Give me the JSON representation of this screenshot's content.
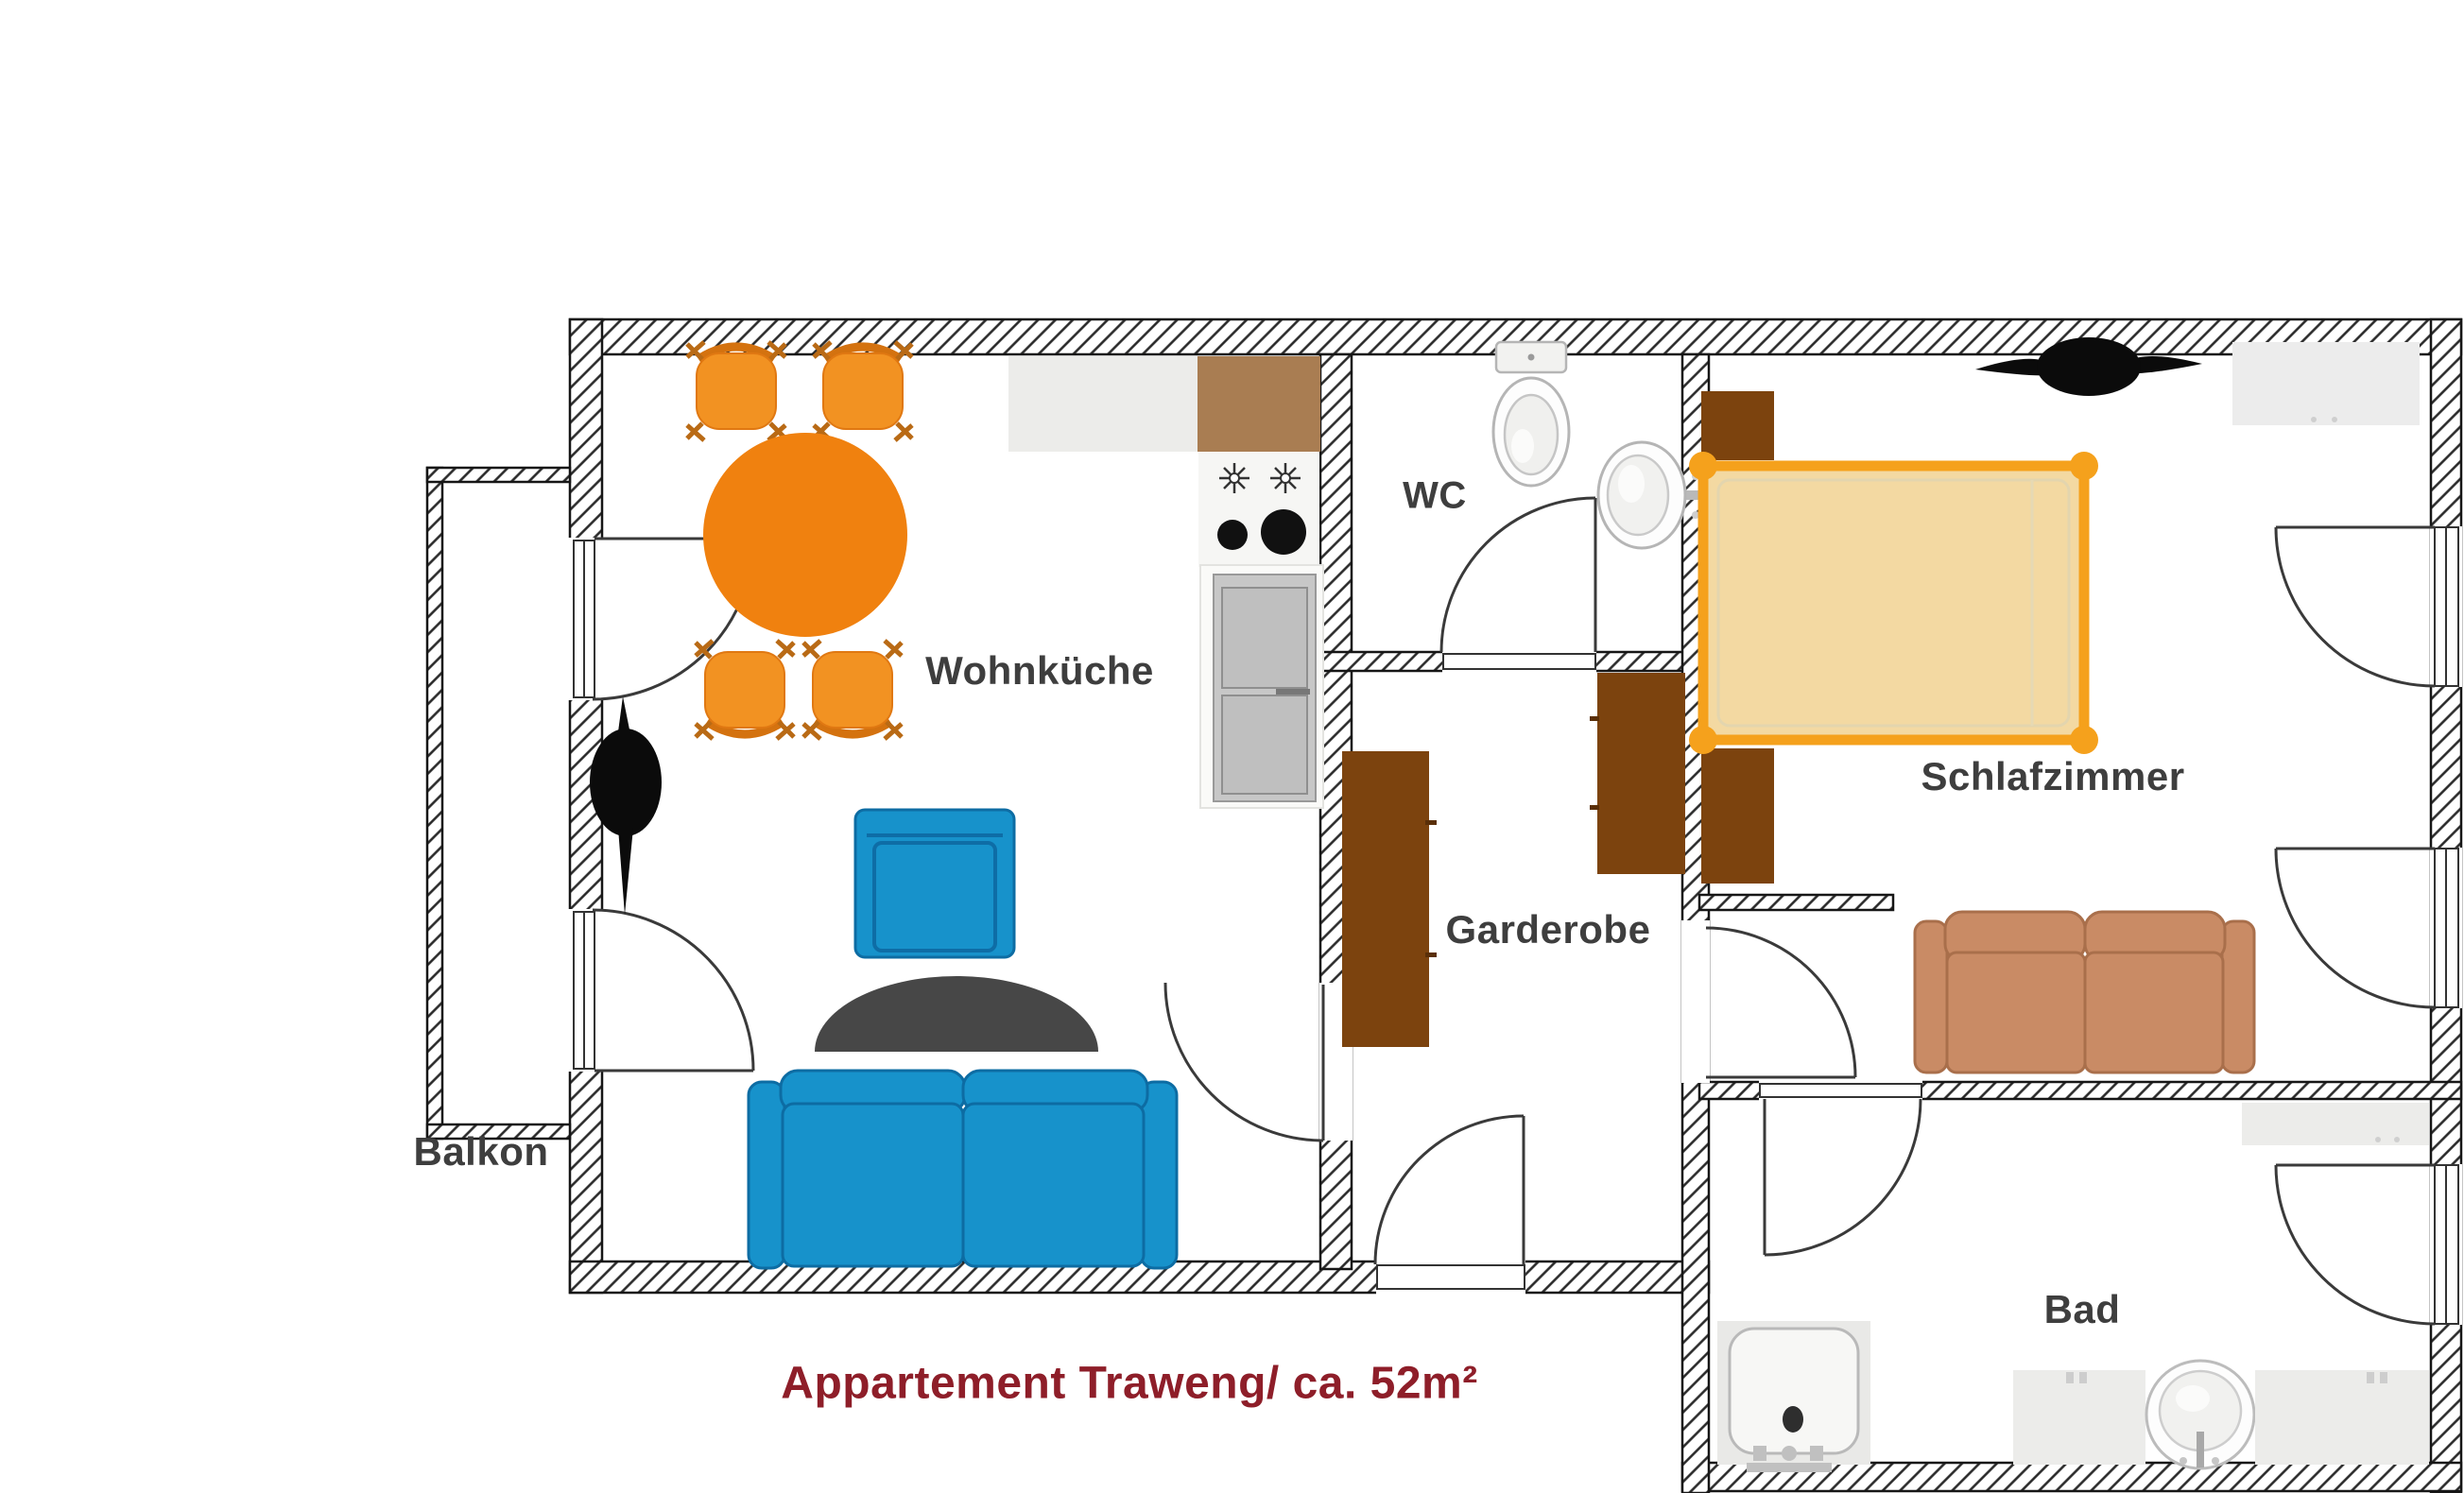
{
  "title": {
    "text": "Appartement Traweng/ ca. 52m²",
    "color": "#8e1e29"
  },
  "rooms": {
    "wohnkueche": {
      "label": "Wohnküche"
    },
    "wc": {
      "label": "WC"
    },
    "garderobe": {
      "label": "Garderobe"
    },
    "schlafzimmer": {
      "label": "Schlafzimmer"
    },
    "bad": {
      "label": "Bad"
    },
    "balkon": {
      "label": "Balkon"
    }
  },
  "colors": {
    "label_text": "#3e3e3e",
    "title_red": "#8e1e29",
    "wall_outline": "#161616",
    "hatch_line": "#2b2b2b",
    "door_line": "#3a3a3a",
    "dining_table": "#f0810f",
    "dining_chair": "#f29222",
    "sofa_blue": "#1792cb",
    "sofa_blue_line": "#0d6ca3",
    "rug_gray": "#474747",
    "kitchen_counter": "#ececea",
    "kitchen_corner_brown": "#a97d52",
    "appliance_gray": "#c7c7c7",
    "wardrobe_brown": "#7c430e",
    "bed_frame_orange": "#f5a11c",
    "bed_mattress": "#f3d9a2",
    "bedroom_sofa_salmon": "#c98b65",
    "fixture_fill": "#fdfdfd",
    "fixture_line": "#b5b5b5",
    "bath_counter": "#ececea",
    "plant_black": "#0b0b0b"
  },
  "furniture_symbols": [
    "dining-table",
    "dining-chair",
    "kitchen-counter",
    "kitchen-corner-cabinet",
    "stove",
    "fridge-freezer",
    "armchair",
    "rug",
    "sofa",
    "potted-plant",
    "toilet",
    "washbasin",
    "wardrobe",
    "double-bed",
    "nightstand",
    "ceiling-fan",
    "loveseat",
    "closet",
    "bathtub",
    "bathroom-counter",
    "bathroom-sink",
    "bath-shelf"
  ]
}
